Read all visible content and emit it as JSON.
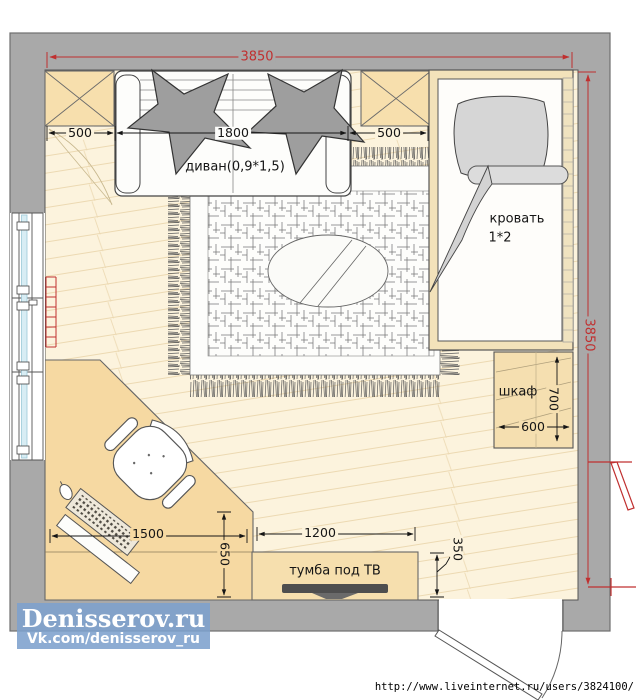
{
  "dims": {
    "total_width": "3850",
    "total_height": "3850",
    "left_offset": "500",
    "sofa_len": "1800",
    "right_offset": "500",
    "wardrobe_h": "700",
    "wardrobe_w": "600",
    "desk_len": "1500",
    "desk_depth": "650",
    "tv_len": "1200",
    "tv_depth": "350"
  },
  "labels": {
    "sofa": "диван(0,9*1,5)",
    "bed1": "кровать",
    "bed2": "1*2",
    "wardrobe": "шкаф",
    "tv": "тумба под ТВ"
  },
  "watermark": {
    "title": "Denisserov.ru",
    "subtitle": "Vk.com/denisserov_ru"
  },
  "footer": {
    "url": "http://www.liveinternet.ru/users/3824100/"
  },
  "colors": {
    "wall_gray": "#a9a9a9",
    "floor_cream": "#fcf3dd",
    "furniture_tan": "#f5dfb0",
    "desk_tan": "#f6d9a2",
    "dimension_red": "#c03030",
    "pillow_gray": "#9e9e9e",
    "watermark_blue": "#7da0cd"
  }
}
